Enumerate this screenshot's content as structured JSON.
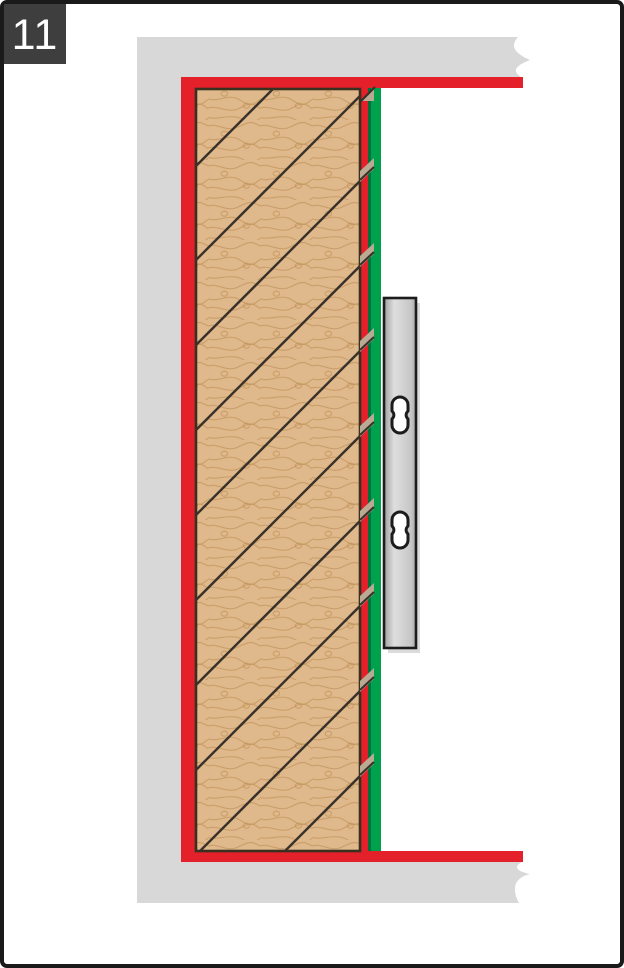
{
  "step_badge": {
    "number": "11"
  },
  "colors": {
    "page_border": "#1a1a1a",
    "step_box_bg": "#3e3e3e",
    "step_box_text": "#ffffff",
    "wall_gray": "#d8d8d8",
    "seal_red": "#e4202b",
    "gasket_green": "#00a14d",
    "gasket_green_dark": "#00713a",
    "wood_fill": "#dfb98c",
    "wood_grain": "#c4945c",
    "wood_outline": "#3a3020",
    "hatch_line": "#39322a",
    "notch_fill": "#b9ab93",
    "bracket_outline": "#1c1c1c",
    "bracket_metal_light": "#dedede",
    "bracket_metal_mid": "#c6c6c6",
    "bracket_metal_dark": "#8f8f8f",
    "slot_fill": "#ffffff"
  },
  "diagram": {
    "hatch": {
      "right_edge_x": 361,
      "left_edge_x": 195,
      "bottom_clip_y": 851,
      "slope": 1,
      "right_edge_ys": [
        95,
        180,
        265,
        350,
        435,
        520,
        605,
        690,
        775
      ],
      "top_partial": {
        "x1": 195,
        "y1": 167,
        "x2": 273,
        "y2": 89
      }
    },
    "notches": {
      "ys": [
        180,
        265,
        350,
        435,
        520,
        605,
        690,
        775
      ]
    },
    "slots": {
      "cx": 400,
      "cys": [
        415,
        530
      ],
      "half_width": 8,
      "half_height": 18,
      "corner_radius": 8,
      "waist_pull": 2.5
    }
  }
}
